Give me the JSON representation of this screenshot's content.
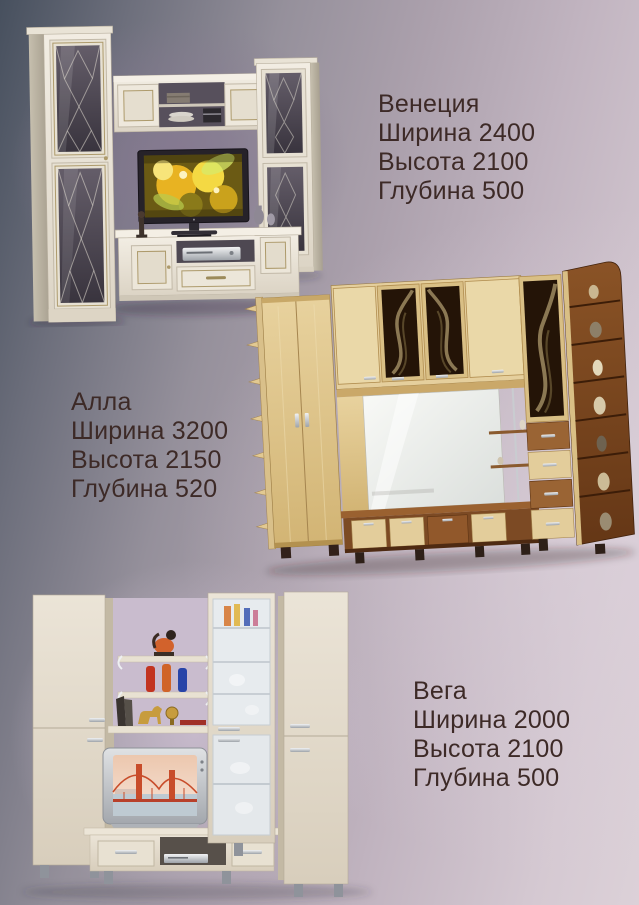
{
  "page": {
    "background": {
      "top_left": "#47505e",
      "center": "#aba0ac",
      "right_light": "#d5c9d2",
      "bottom_left": "#7a7f8b",
      "wall_behind_venecia": "#867991",
      "wall_behind_vega": "#c9bcce"
    },
    "text_color": "#3d2a27"
  },
  "products": [
    {
      "name": "Венеция",
      "specs": [
        "Ширина 2400",
        "Высота 2100",
        "Глубина 500"
      ],
      "photo_alt": "Кремовая классическая стенка: две витрины со стеклом, навесной мост с полками, тумба с плоским телевизором"
    },
    {
      "name": "Алла",
      "specs": [
        "Ширина 3200",
        "Высота 2150",
        "Глубина 520"
      ],
      "photo_alt": "Светлая стенка из бука: шкаф, зеркало, тёмные стеклянные фасады с узором, ящики и угловые полки из ореха"
    },
    {
      "name": "Вега",
      "specs": [
        "Ширина 2000",
        "Высота 2100",
        "Глубина 500"
      ],
      "photo_alt": "Светлая стенка: пеналы, витрина с матовым стеклом, открытые полки с декором и телевизор"
    }
  ]
}
